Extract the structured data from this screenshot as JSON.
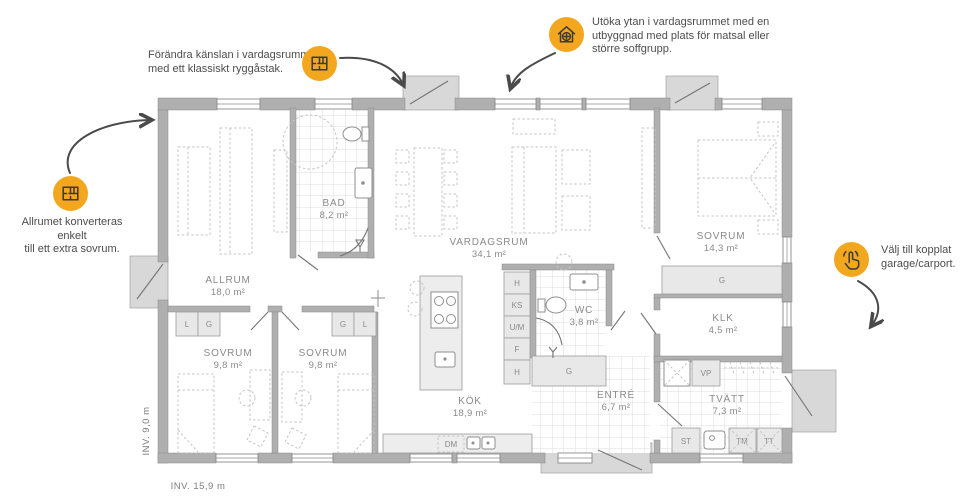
{
  "annotations": {
    "ridge_roof": {
      "line1": "Förändra känslan i vardagsrummet",
      "line2": "med ett klassiskt ryggåstak."
    },
    "extension": {
      "line1": "Utöka ytan i vardagsrummet med en",
      "line2": "utbyggnad med plats för matsal eller",
      "line3": "större soffgrupp."
    },
    "allrum_convert": {
      "line1": "Allrumet konverteras enkelt",
      "line2": "till ett extra sovrum."
    },
    "garage": {
      "line1": "Välj till kopplat",
      "line2": "garage/carport."
    }
  },
  "rooms": {
    "allrum": {
      "name": "ALLRUM",
      "area": "18,0 m²"
    },
    "bad": {
      "name": "BAD",
      "area": "8,2 m²"
    },
    "vardagsrum": {
      "name": "VARDAGSRUM",
      "area": "34,1 m²"
    },
    "sovrum_master": {
      "name": "SOVRUM",
      "area": "14,3 m²"
    },
    "sovrum_left": {
      "name": "SOVRUM",
      "area": "9,8 m²"
    },
    "sovrum_mid": {
      "name": "SOVRUM",
      "area": "9,8 m²"
    },
    "kok": {
      "name": "KÖK",
      "area": "18,9 m²"
    },
    "wc": {
      "name": "WC",
      "area": "3,8 m²"
    },
    "klk": {
      "name": "KLK",
      "area": "4,5 m²"
    },
    "entre": {
      "name": "ENTRÉ",
      "area": "6,7 m²"
    },
    "tvatt": {
      "name": "TVÄTT",
      "area": "7,3 m²"
    }
  },
  "labels": {
    "l": "L",
    "g": "G",
    "h": "H",
    "ks": "KS",
    "um": "U/M",
    "f": "F",
    "vp": "VP",
    "dm": "DM",
    "st": "ST",
    "tm": "TM",
    "tt": "TT"
  },
  "dimensions": {
    "interior_width": "INV. 15,9 m",
    "interior_depth": "INV. 9,0 m"
  },
  "colors": {
    "accent_orange": "#F2A71E",
    "wall_gray": "#AFAFAF",
    "text_gray": "#4D4D4D"
  }
}
